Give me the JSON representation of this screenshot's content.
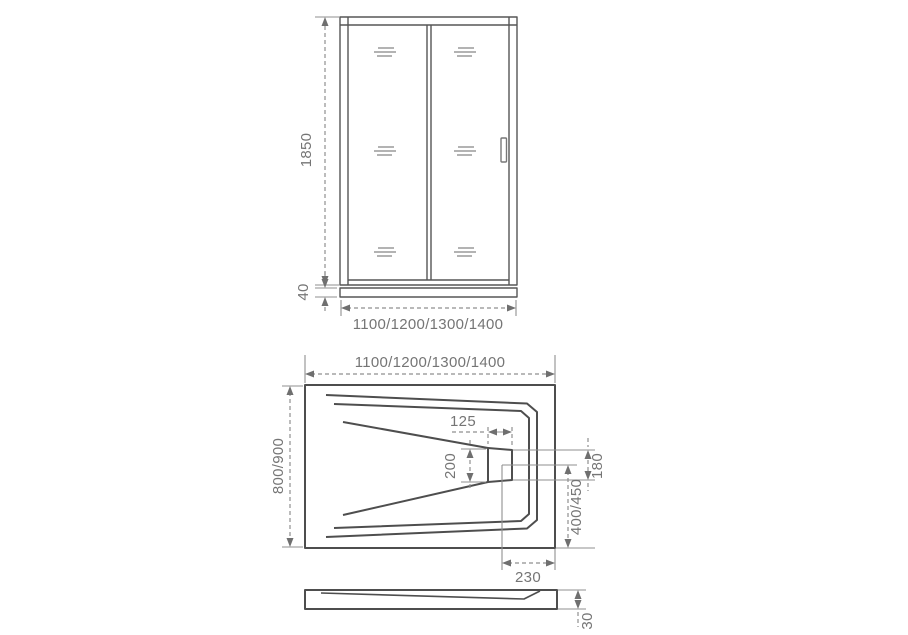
{
  "drawing": {
    "title": "Shower sliding door and tray — dimensional technical drawing",
    "colors": {
      "outline": "#4e4e4e",
      "dimension_line": "#8f8f8f",
      "label_text": "#757575",
      "background": "#ffffff"
    },
    "views": {
      "door_front": {
        "dims": {
          "height": "1850",
          "sill_height": "40",
          "width_options": "1100/1200/1300/1400"
        }
      },
      "tray_plan": {
        "dims": {
          "width_options": "1100/1200/1300/1400",
          "depth_options": "800/900",
          "drain_width": "125",
          "drain_left_side": "200",
          "drain_right_side": "180",
          "drain_center_from_bottom": "400/450",
          "drain_center_from_right": "230"
        }
      },
      "tray_side": {
        "dims": {
          "height": "30"
        }
      }
    }
  }
}
